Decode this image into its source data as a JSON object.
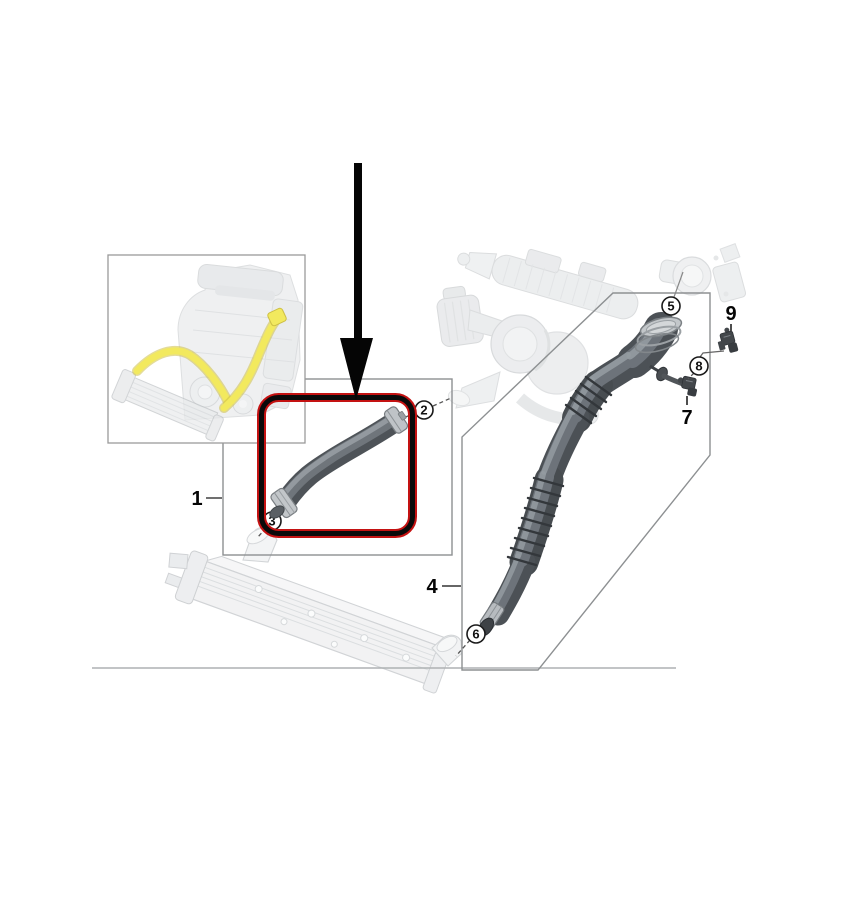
{
  "diagram": {
    "description": "Vehicle charge-air (intercooler) hose parts diagram; part hose highlighted with red box and large black arrow",
    "callouts": {
      "n1": "1",
      "n2": "2",
      "n3": "3",
      "n4": "4",
      "n5": "5",
      "n6": "6",
      "n7": "7",
      "n8": "8",
      "n9": "9"
    },
    "icons": {
      "arrow": "down-arrow-icon",
      "sensor_7": "sensor-icon",
      "sensor_9": "sensor-icon"
    },
    "colors": {
      "background": "#ffffff",
      "highlight_box_red": "#c41212",
      "highlight_box_black": "#0a0a0a",
      "arrow": "#000000",
      "frame_line": "#8d9092",
      "leader_line": "#555555",
      "hose_dark": "#4c5156",
      "hose_mid": "#6d737a",
      "hose_light": "#949ba1",
      "metal_clamp": "#c3c7ca",
      "faded_part": "#dcdfe2",
      "yellow_highlight": "#f2e95e"
    }
  }
}
